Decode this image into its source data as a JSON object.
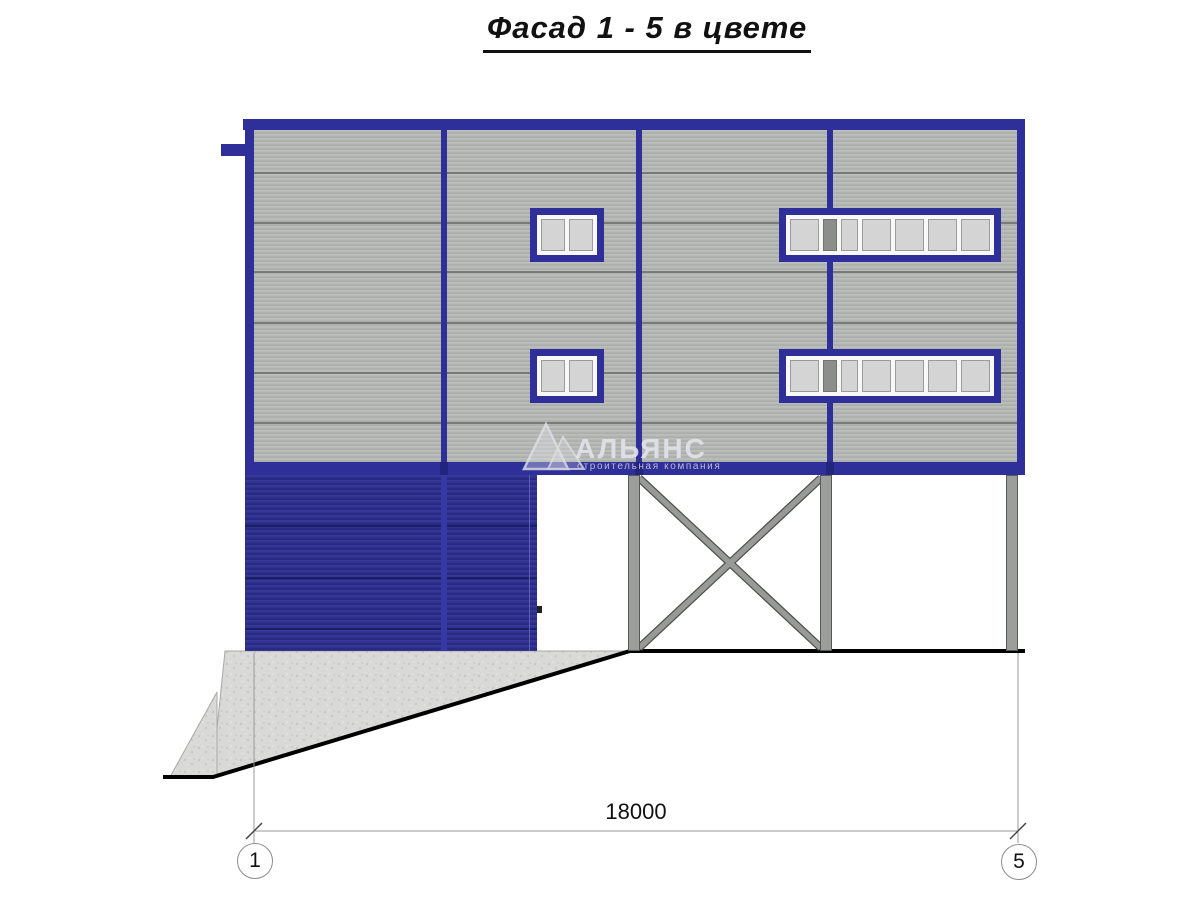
{
  "title": "Фасад 1 - 5 в цвете",
  "watermark": {
    "logo_icon": "company-logo-triangle",
    "name": "АЛЬЯНС",
    "tagline": "строительная компания"
  },
  "dimension": {
    "value": "18000"
  },
  "axes": {
    "left": "1",
    "right": "5"
  },
  "colors": {
    "frame_blue": "#2e2f99",
    "gate_blue": "#2b2d90",
    "panel_gray": "#b4b7b4",
    "glass_gray": "#d4d4d4",
    "column_gray": "#9b9e9b",
    "concrete_gray": "#d9d9d7",
    "line_black": "#000000"
  }
}
